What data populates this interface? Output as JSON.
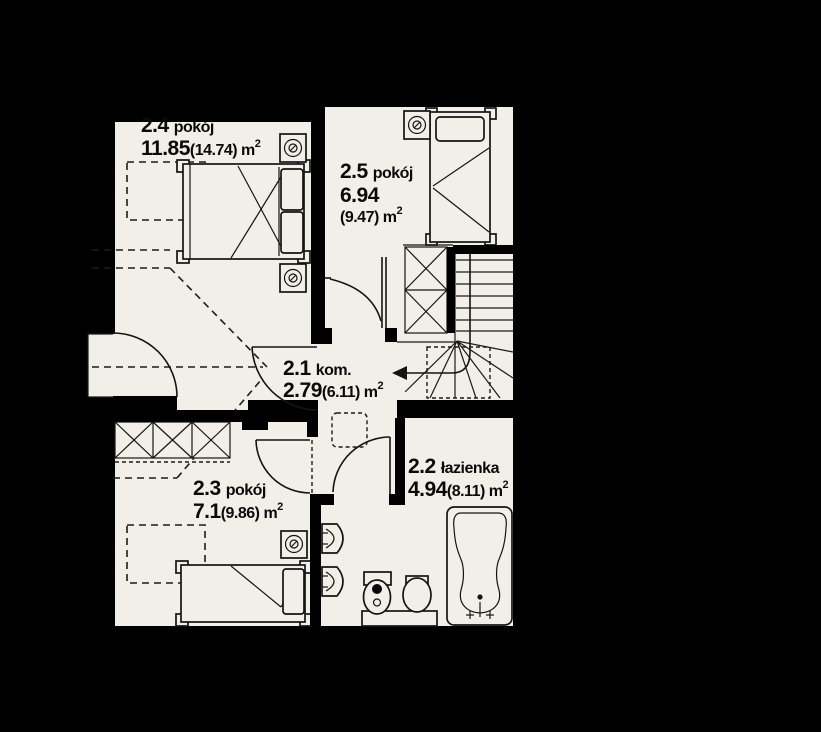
{
  "plan": {
    "type": "floor-plan",
    "language": "pl",
    "rooms": [
      {
        "id": "2.4",
        "name": "pokój",
        "area": "11.85",
        "unit": "(14.74) m",
        "sup": "2"
      },
      {
        "id": "2.5",
        "name": "pokój",
        "area": "6.94",
        "unit": "(9.47) m",
        "sup": "2"
      },
      {
        "id": "2.1",
        "name": "kom.",
        "area": "2.79",
        "unit": "(6.11) m",
        "sup": "2"
      },
      {
        "id": "2.2",
        "name": "łazienka",
        "area": "4.94",
        "unit": "(8.11) m",
        "sup": "2"
      },
      {
        "id": "2.3",
        "name": "pokój",
        "area": "7.1",
        "unit": "(9.86) m",
        "sup": "2"
      }
    ],
    "colors": {
      "background": "#000000",
      "floor": "#f2efe8",
      "wall": "#000000",
      "line": "#141414"
    }
  }
}
